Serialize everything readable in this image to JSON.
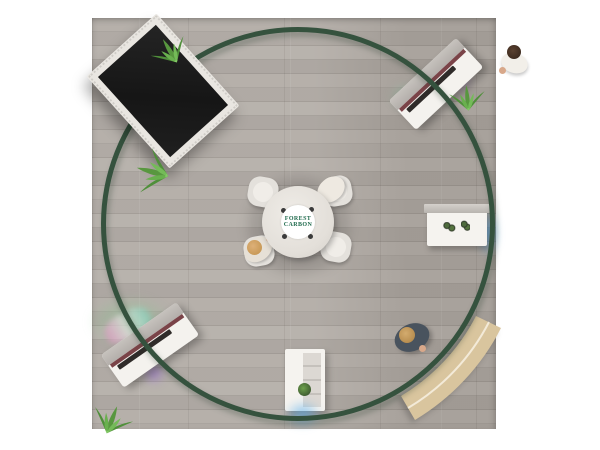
{
  "scene": {
    "description": "Top-down 3D render of a square trade-show booth exhibit",
    "background_color": "#ffffff"
  },
  "floor": {
    "label": "gray wood plank floor",
    "base_color": "#aaa49e"
  },
  "hanging_ring": {
    "label": "circular green hanging ring sign",
    "color": "#35523e"
  },
  "video_wall": {
    "label": "large angled LED video wall",
    "screen_color": "#1c1c1c",
    "frame_color": "#e9e6e1"
  },
  "meeting_table": {
    "label": "round meeting table with four tub chairs",
    "top_color": "#e6e2dc",
    "chair_color": "#e4e1dc",
    "chairs": 4,
    "seated_people": 2,
    "logo": {
      "line1": "FOREST",
      "line2": "CARBON",
      "text_color": "#1e6a4c",
      "background": "#ffffff"
    }
  },
  "kiosks": [
    {
      "id": "top-right-counter",
      "body_color": "#f4f2ee",
      "accent_stripe": "#7a4348",
      "glow_color": "#a56ee6",
      "has_plant": true
    },
    {
      "id": "bottom-left-counter",
      "body_color": "#f4f2ee",
      "accent_stripe": "#7a4348",
      "glow_color": "#9664e1",
      "has_plant": true
    }
  ],
  "display_counters": [
    {
      "id": "right-display-counter",
      "color": "#f5f3ef",
      "glow_color": "#50aaeb",
      "items": "small product displays"
    },
    {
      "id": "bottom-display-counter",
      "color": "#f5f3ef",
      "glow_color": "#50aaeb",
      "items": "small plant on shelf"
    }
  ],
  "bench": {
    "id": "curved-tan-bench",
    "color": "#d9c59e",
    "trim_color": "#f3ead8"
  },
  "plants": {
    "count": 4,
    "leaf_dark": "#4f8f3a",
    "leaf_light": "#69b04e"
  },
  "people": [
    {
      "id": "visitor-top-right",
      "shirt": "#f2efe9",
      "hair": "#3c2a1e"
    },
    {
      "id": "visitor-bottom-right",
      "shirt": "#49535e",
      "hair": "#b68c4e"
    },
    {
      "id": "visitor-seated-north",
      "shirt": "#eee9e1",
      "hair": "#e7e1d5"
    },
    {
      "id": "visitor-seated-south",
      "shirt": "#e6e0d6",
      "hair": "#c99a58"
    }
  ],
  "floor_glows": {
    "green": "rgba(130,205,140,0.5)",
    "purple": "rgba(160,105,228,0.55)",
    "blue": "rgba(80,170,235,0.7)",
    "rainbow": "pink-white-teal streak"
  }
}
